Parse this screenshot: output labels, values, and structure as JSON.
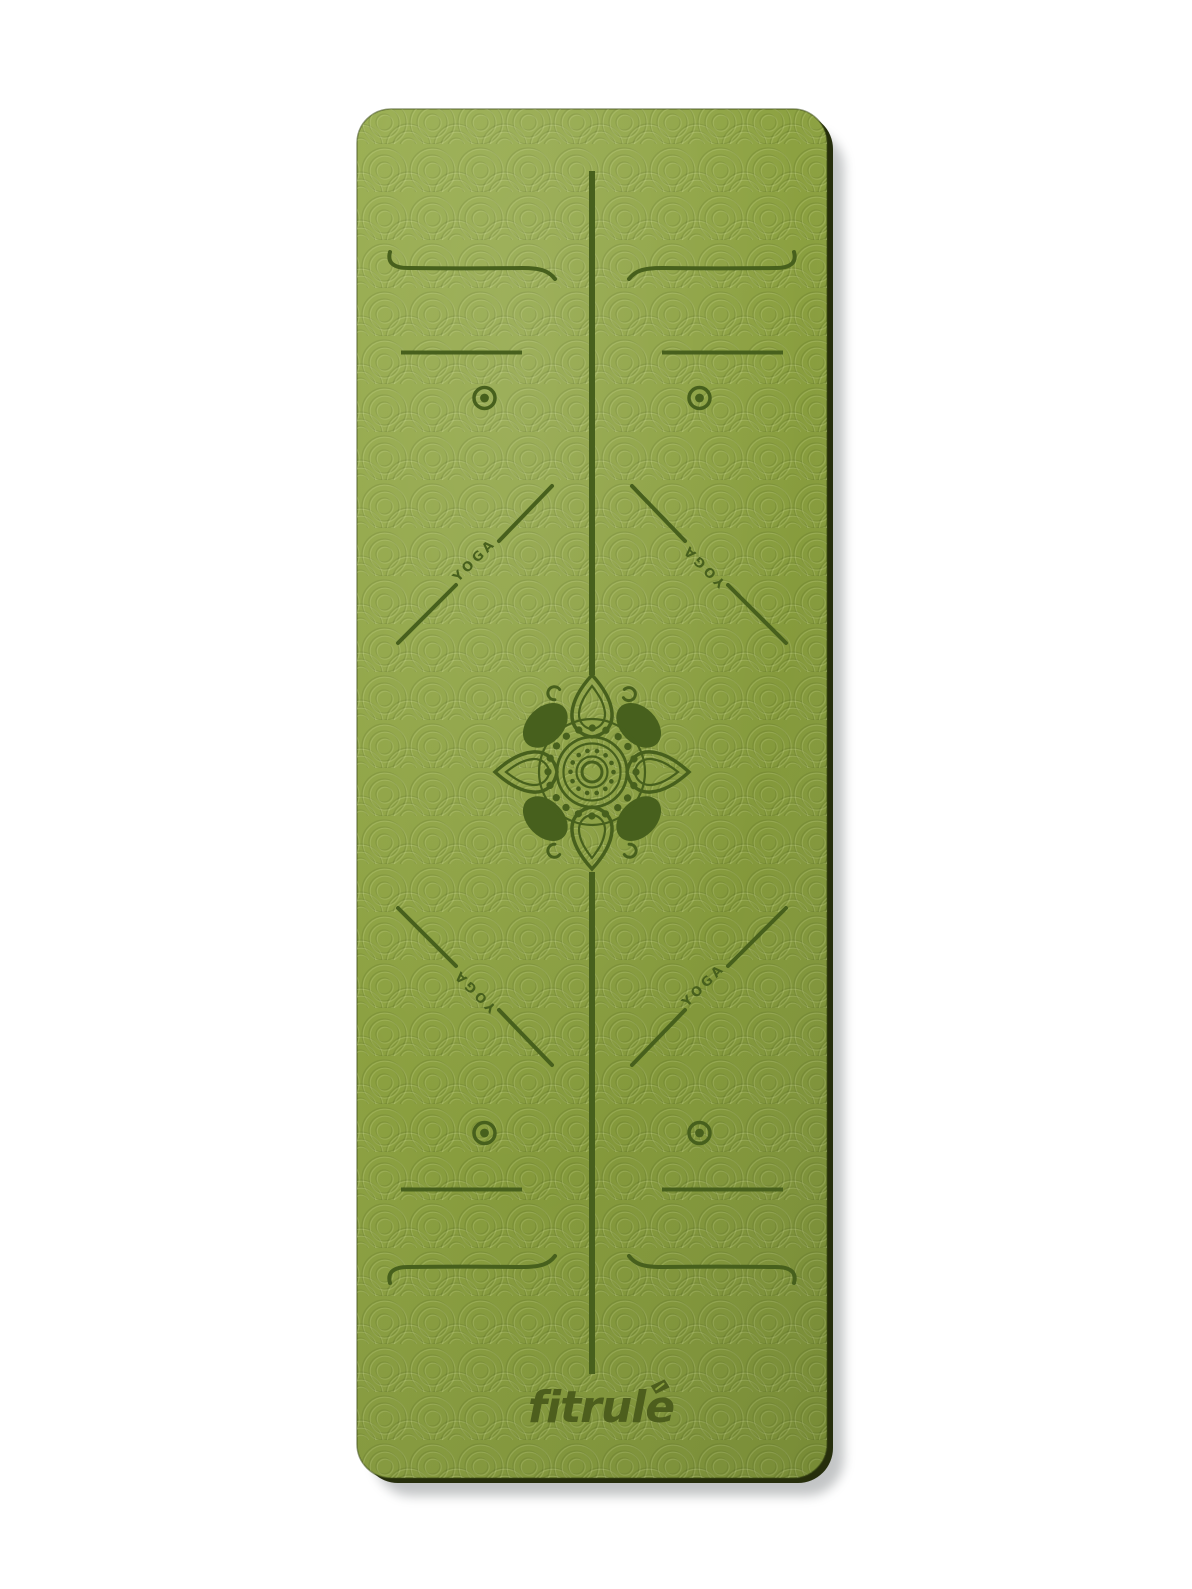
{
  "product": {
    "brand_label": "fitrule",
    "yoga_labels": [
      "YOGA",
      "YOGA",
      "YOGA",
      "YOGA"
    ]
  },
  "colors": {
    "page_background": "#ffffff",
    "mat_green_light": "#97ac4d",
    "mat_green": "#8ba040",
    "mat_green_deep": "#7d9237",
    "marking_olive": "#47601d",
    "logo_olive": "#4d5e1d",
    "mat_edge_dark": "#262e0c",
    "drop_shadow": "#9aa0a3"
  },
  "icons": {
    "center_icon": "lotus-mandala-icon",
    "corner_markers": "circle-dot-marker",
    "brand_mark": "registered-badge-icon"
  }
}
